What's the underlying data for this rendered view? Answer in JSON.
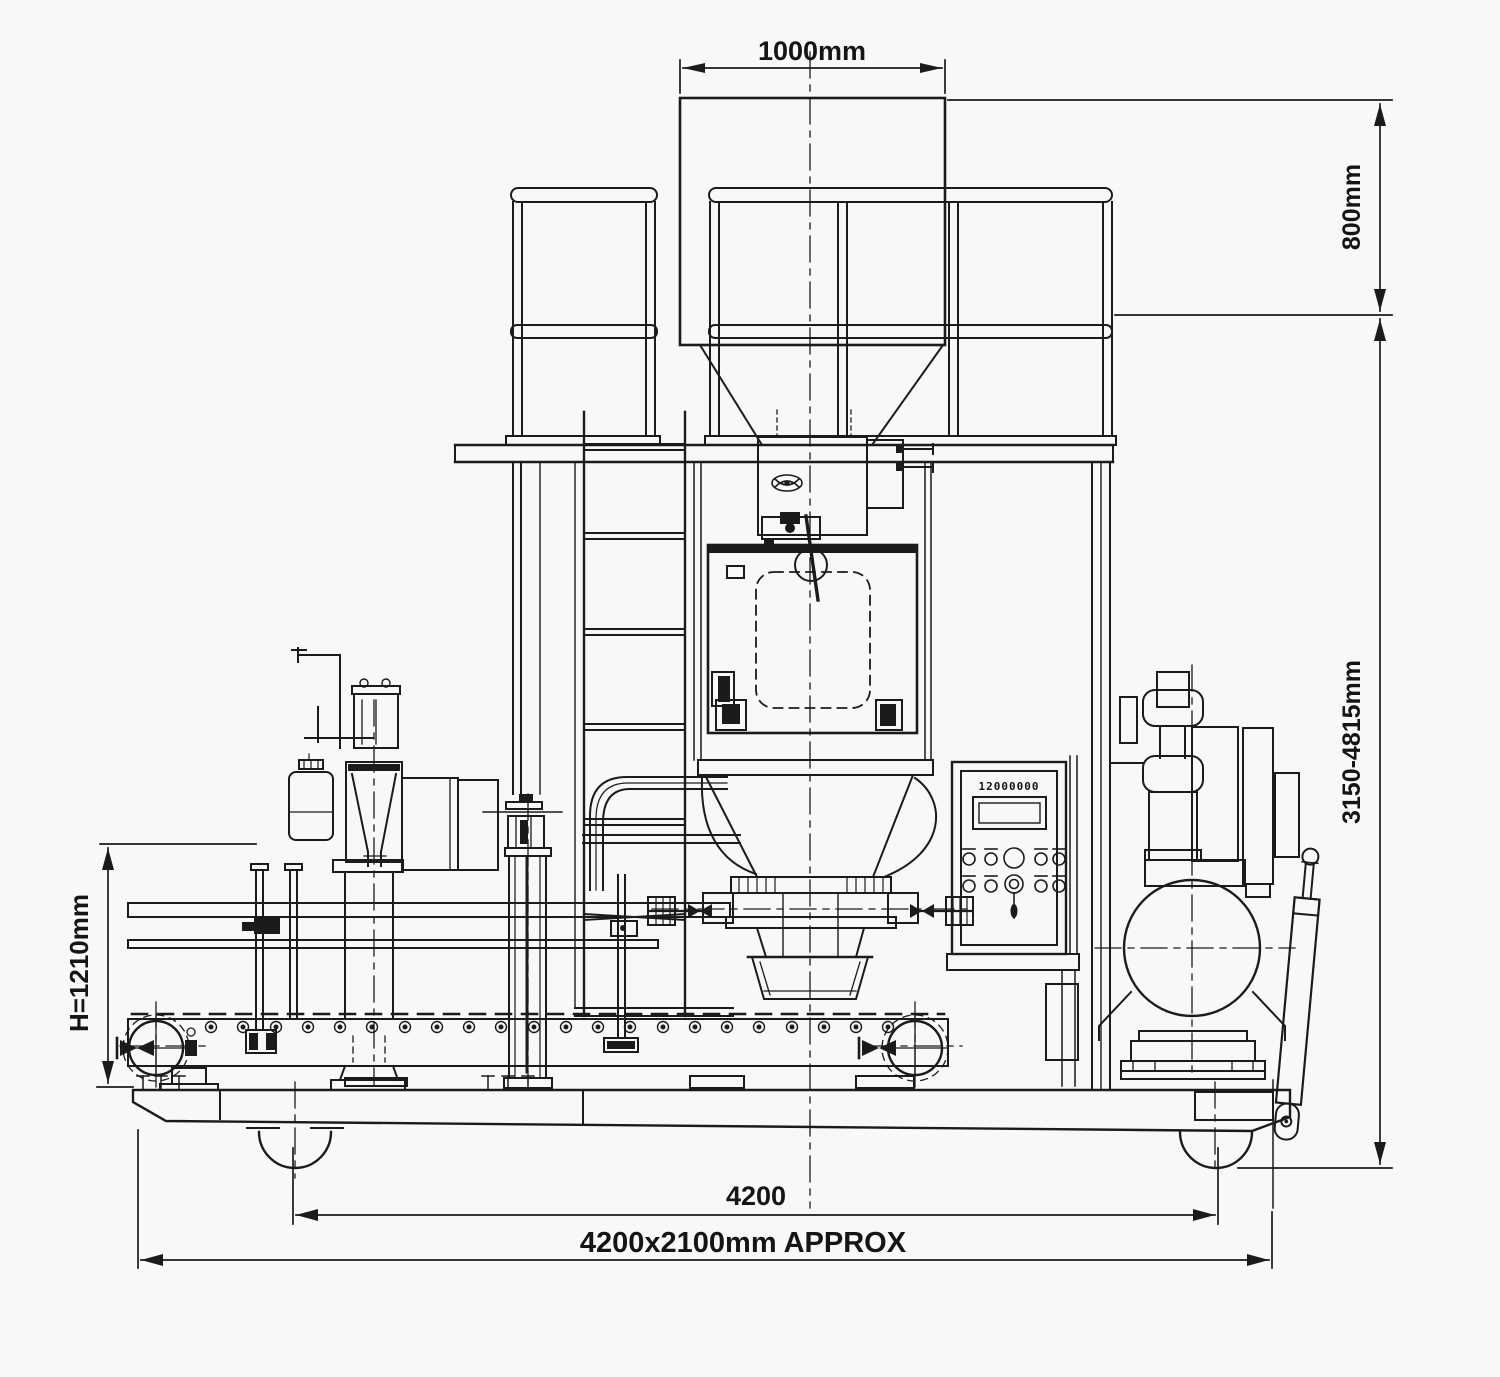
{
  "drawing": {
    "title_hidden": "",
    "background": "#f8f8f6",
    "line_color": "#1b1b1b",
    "dimensions": {
      "top_width": "1000mm",
      "upper_right_height": "800mm",
      "overall_height": "3150-4815mm",
      "conveyor_height": "H=1210mm",
      "bottom_span": "4200",
      "footprint": "4200x2100mm APPROX"
    },
    "control_panel": {
      "display_value": "12000000"
    }
  }
}
